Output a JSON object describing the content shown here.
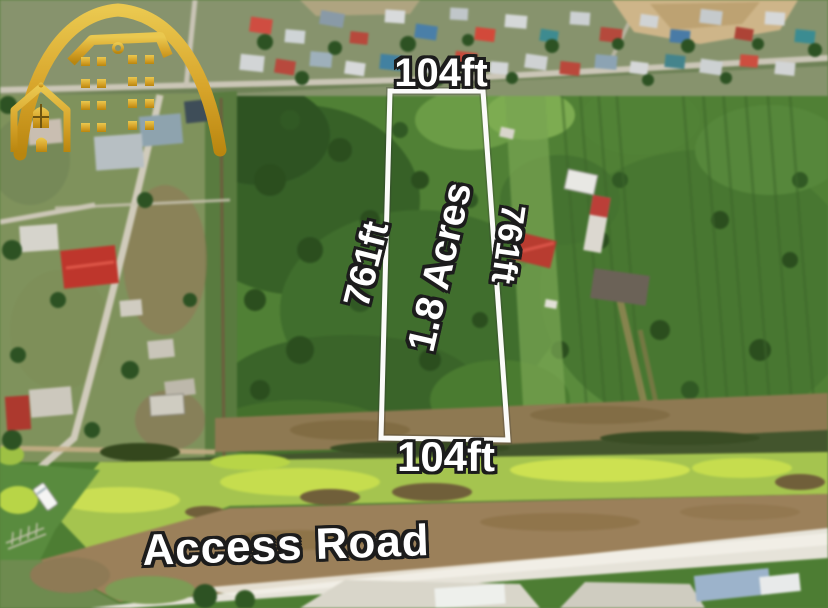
{
  "annotations": {
    "top_width": "104ft",
    "bottom_width": "104ft",
    "left_length": "761ft",
    "right_length": "761ft",
    "area": "1.8 Acres",
    "road": "Access Road"
  },
  "logo": {
    "name": "gold-arch-buildings-logo",
    "color": "#d9a92c"
  },
  "colors": {
    "boundary_line": "#ffffff",
    "label_fill": "#ffffff",
    "label_outline": "#1c1c1c",
    "field_green": "#4f7c36",
    "access_road": "#e6e3da"
  }
}
